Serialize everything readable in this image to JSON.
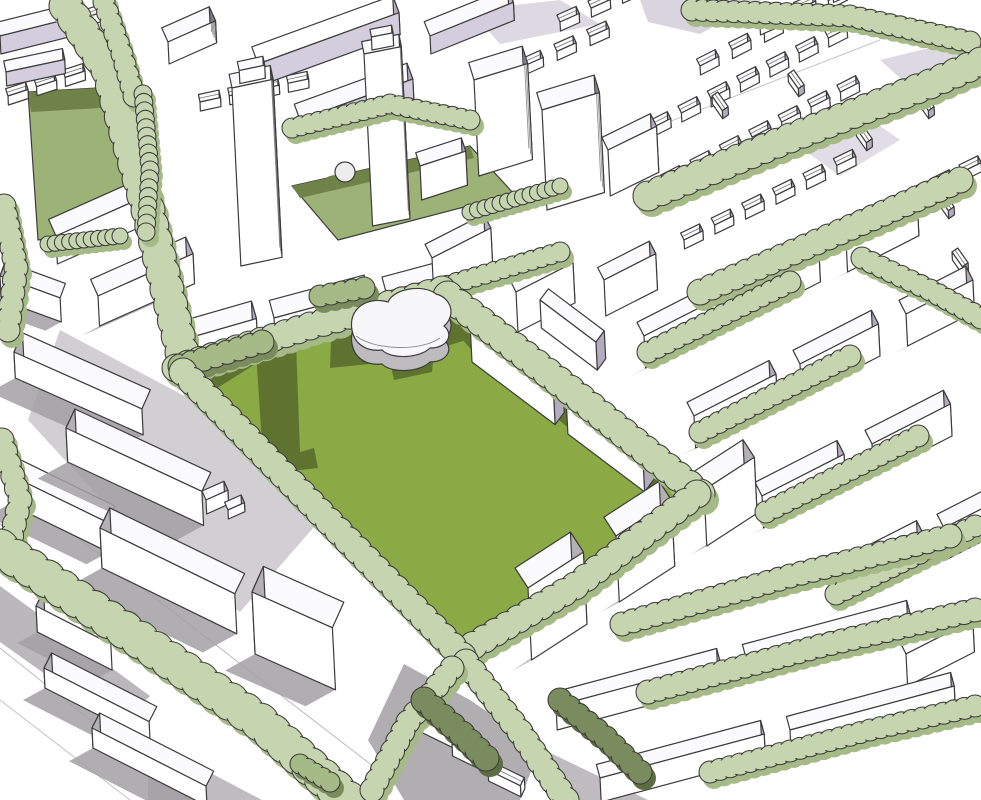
{
  "scene": {
    "title": "Urban masterplan aerial sketch",
    "type": "hand-drawn architectural massing perspective",
    "landmarks": [
      {
        "name": "central-park-lawn",
        "description": "Large green lawn at the heart of the plan with cast shadows"
      },
      {
        "name": "park-pavilion",
        "description": "Curved free-form pavilion building at the north corner of the lawn"
      },
      {
        "name": "twin-towers",
        "description": "Two tall slender residential towers north-west of the park"
      },
      {
        "name": "dome-kiosk",
        "description": "Small domed kiosk on the lawn between the towers"
      },
      {
        "name": "small-green",
        "description": "Smaller green square in the top-left block"
      },
      {
        "name": "tree-lined-streets",
        "description": "Scalloped tree rows along the diagonal street grid"
      },
      {
        "name": "terraced-housing",
        "description": "Fine-grain terraced housing fabric in the north-east"
      },
      {
        "name": "slab-blocks",
        "description": "White housing slabs, terraces and point blocks framing the park"
      }
    ]
  },
  "palette": {
    "paper": "#ffffff",
    "ink": "#3c3c3c",
    "field-green": "#8baa46",
    "field-shadow": "#5e7330",
    "sage": "#c6d5af",
    "sage-dark": "#a6ba87",
    "olive": "#9db277",
    "olive-shadow": "#6f8248",
    "tree-dark": "#7a8c5d",
    "tree-darker": "#5d6d42",
    "lavender": "#b3abc0",
    "lavender-light": "#d3cddd",
    "side-gray": "#b4b1b5",
    "shadow-gray": "#a3a0a4",
    "pavilion-gray": "#bdbbbe",
    "roof-white": "#fbfafc"
  }
}
